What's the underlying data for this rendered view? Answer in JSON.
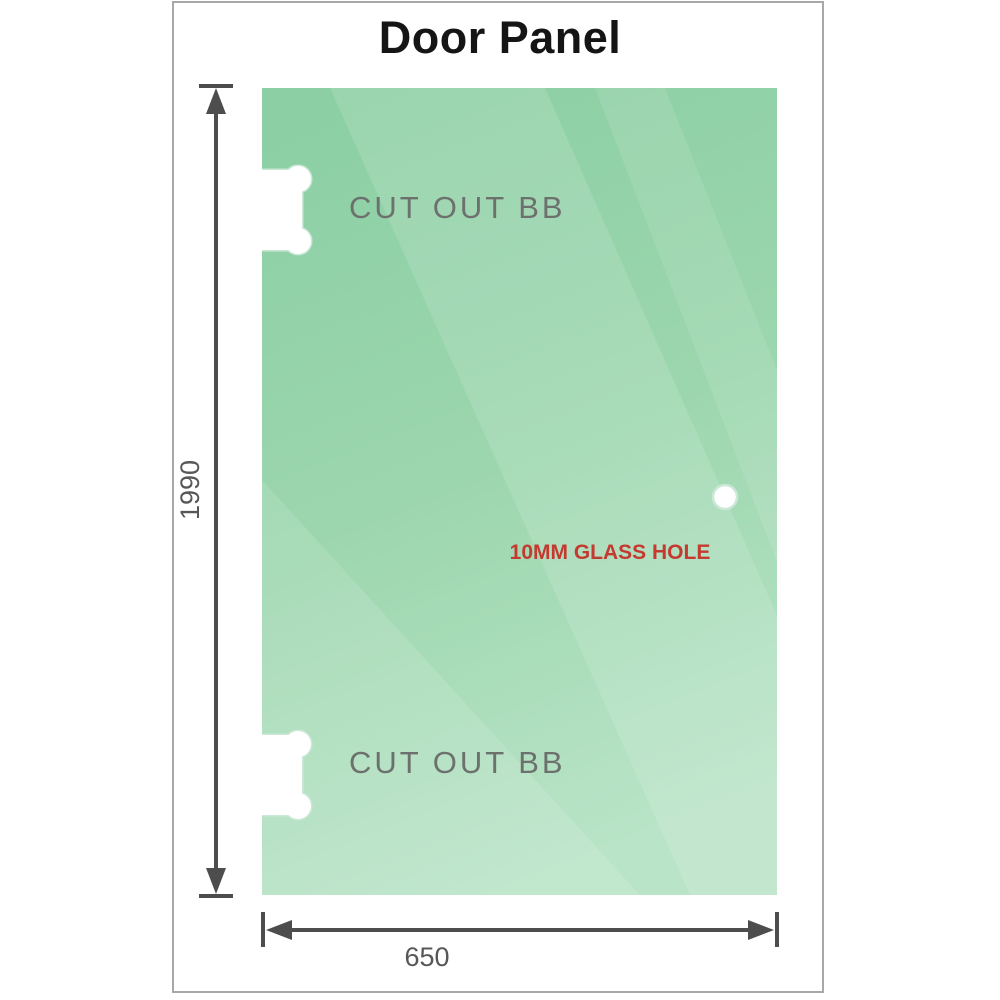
{
  "title": "Door Panel",
  "drawing": {
    "cutout_top_label": "CUT OUT BB",
    "cutout_bottom_label": "CUT OUT BB",
    "glass_hole_label": "10MM GLASS HOLE",
    "height_dimension": "1990",
    "width_dimension": "650"
  },
  "colors": {
    "glass_green_dark": "#8ccfa4",
    "glass_green_mid": "#9cd6ae",
    "glass_green_light": "#b9e4c7",
    "cutout_outline": "#cbe8d7",
    "dimension_gray": "#4d4d4d",
    "dim_label_gray": "#575757",
    "cutout_label_gray": "#6d716d",
    "hole_label_red": "#c43a31",
    "page_border_gray": "#a8a8a8",
    "title_black": "#151515"
  }
}
